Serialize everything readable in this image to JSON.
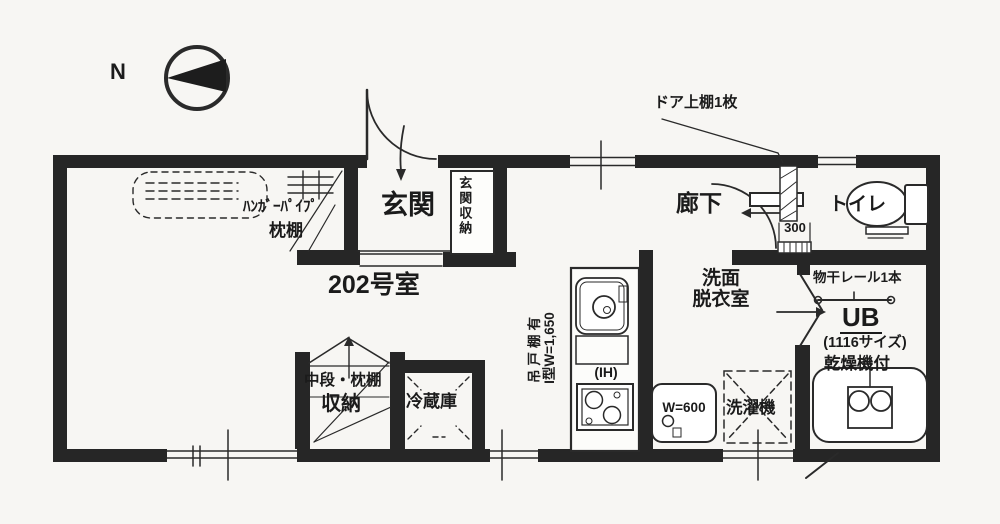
{
  "plan": {
    "room_number": "202号室",
    "compass_north": "N"
  },
  "labels": {
    "entrance": "玄関",
    "entrance_storage": "玄関収納",
    "corridor": "廊下",
    "toilet": "トイレ",
    "washroom_line1": "洗面",
    "washroom_line2": "脱衣室",
    "bath_unit": "UB",
    "bath_size": "(1116サイズ)",
    "bath_dryer": "乾燥機付",
    "drying_rail": "物干レール1本",
    "storage": "収納",
    "storage_shelf": "中段・枕棚",
    "refrigerator": "冷蔵庫",
    "washing_machine": "洗濯機"
  },
  "annotations": {
    "hanger_pipe": "ﾊﾝｶﾞｰﾊﾟｲﾌﾟ",
    "pillow_shelf": "枕棚",
    "door_top_shelf": "ドア上棚1枚",
    "kitchen_cupboard": "吊戸棚有",
    "kitchen_spec": "I型W=1,650",
    "ih": "(IH)",
    "basin_width": "W=600",
    "door_dim": "300"
  },
  "colors": {
    "wall": "#262626",
    "line": "#2e2e2e",
    "paper": "#f7f6f3"
  }
}
